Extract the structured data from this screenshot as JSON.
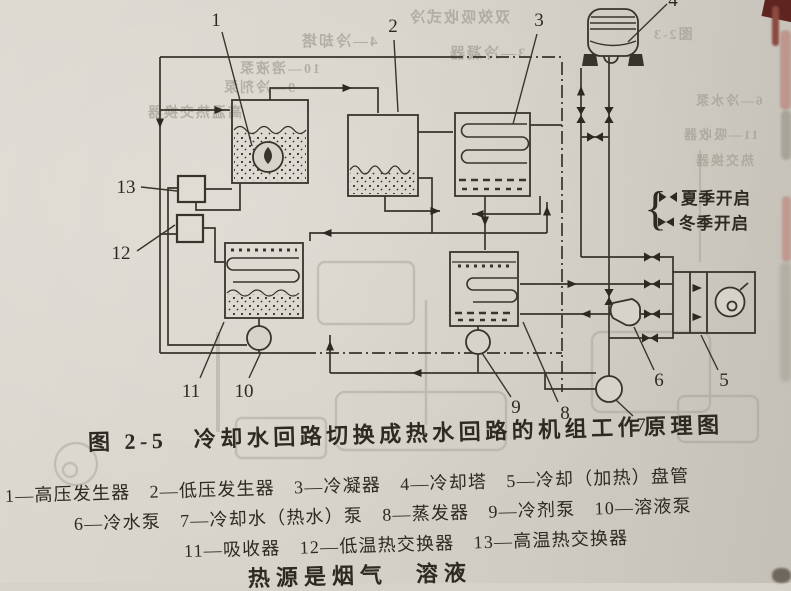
{
  "page": {
    "figure_caption": "图 2-5　冷却水回路切换成热水回路的机组工作原理图",
    "legend_lines": [
      "1—高压发生器　2—低压发生器　3—冷凝器　4—冷却塔　5—冷却（加热）盘管",
      "6—冷水泵　7—冷却水（热水）泵　8—蒸发器　9—冷剂泵　10—溶液泵",
      "11—吸收器　12—低温热交换器　13—高温热交换器"
    ],
    "bottom_partial_text": "热源是烟气　溶液",
    "valve_legend": {
      "brace": "{",
      "summer_label": "夏季开启",
      "winter_label": "冬季开启"
    }
  },
  "diagram": {
    "labels": {
      "n1": "1",
      "n2": "2",
      "n3": "3",
      "n4": "4",
      "n5": "5",
      "n6": "6",
      "n7": "7",
      "n8": "8",
      "n9": "9",
      "n10": "10",
      "n11": "11",
      "n12": "12",
      "n13": "13"
    }
  },
  "ghost_text": {
    "g1": "双效吸收式冷",
    "g2": "图2-3",
    "g3": "4—冷却塔",
    "g4": "3—冷凝器",
    "g5": "10—溶液泵",
    "g6": "9—冷剂泵",
    "g7": "高温热交换器",
    "g8": "6—冷水泵",
    "g9": "11—吸收器",
    "g10": "热交换器"
  },
  "colors": {
    "paper": "#d7d3ca",
    "ink": "#38342c",
    "ghost": "#a29f93",
    "corner_mark": "#5f241f",
    "pink_smudge": "#bc8f86"
  }
}
